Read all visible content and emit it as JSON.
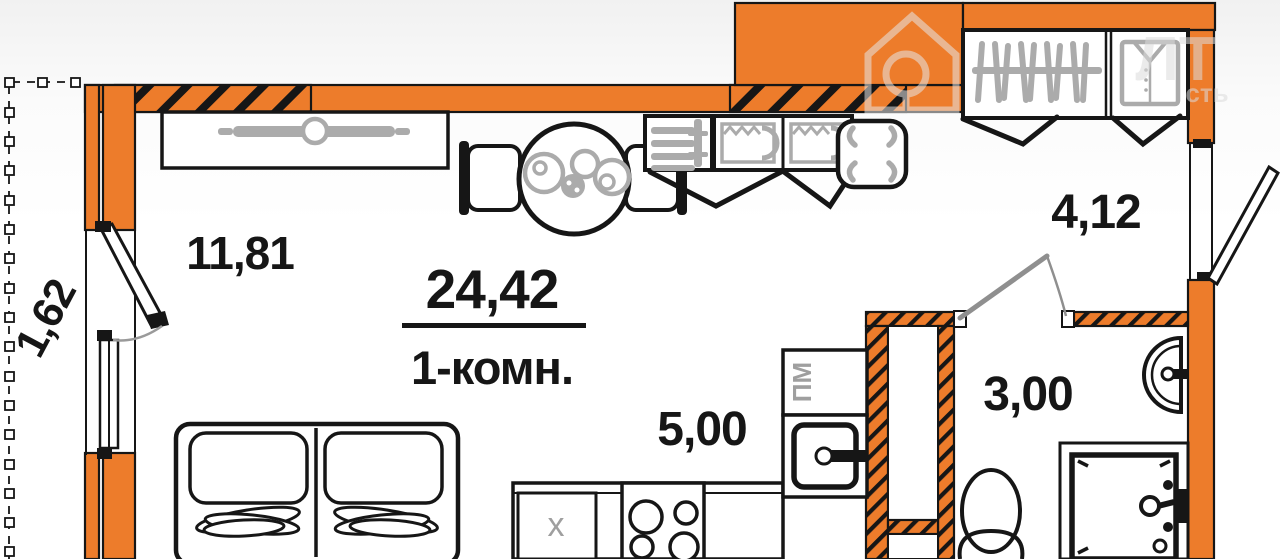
{
  "plan": {
    "total_area": "24,42",
    "type_label": "1-комн.",
    "rooms": {
      "living": {
        "label": "11,81"
      },
      "kitchen": {
        "label": "5,00"
      },
      "hallway": {
        "label": "4,12"
      },
      "bathroom": {
        "label": "3,00"
      },
      "balcony": {
        "label": "1,62"
      }
    },
    "appliances": {
      "dishwasher": "ПМ",
      "fridge": "x"
    },
    "watermark": {
      "line1": "ЛТ",
      "line2": "сть"
    },
    "colors": {
      "wall_fill": "#ed7c2b",
      "outline": "#161616",
      "furniture_gray": "#ababab",
      "door_gray": "#8f8f8f",
      "background": "#ffffff"
    }
  }
}
